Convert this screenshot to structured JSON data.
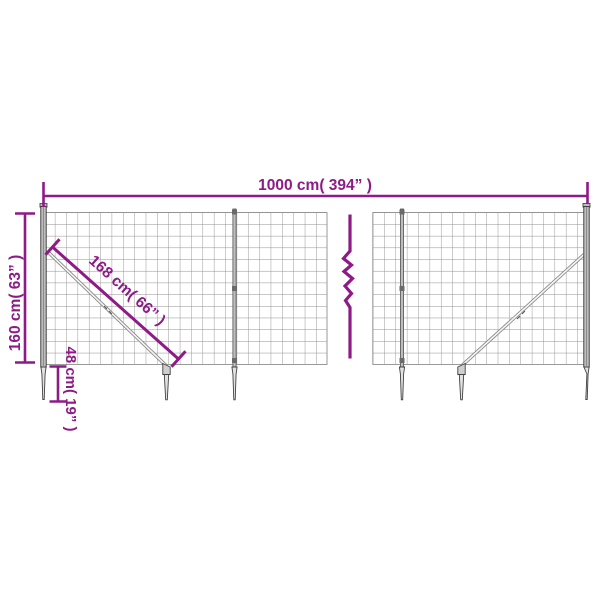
{
  "colors": {
    "accent": "#8e1a87",
    "wire": "#8f8f8f",
    "metal_fill": "#d6d6d6",
    "metal_light": "#e6e6e6",
    "metal_dark": "#4a4a4a",
    "background": "#ffffff"
  },
  "dimensions": {
    "width_label": "1000 cm( 394” )",
    "height_label": "160 cm( 63” )",
    "diagonal_label": "168 cm( 66” )",
    "spike_label": "48 cm( 19” )"
  }
}
